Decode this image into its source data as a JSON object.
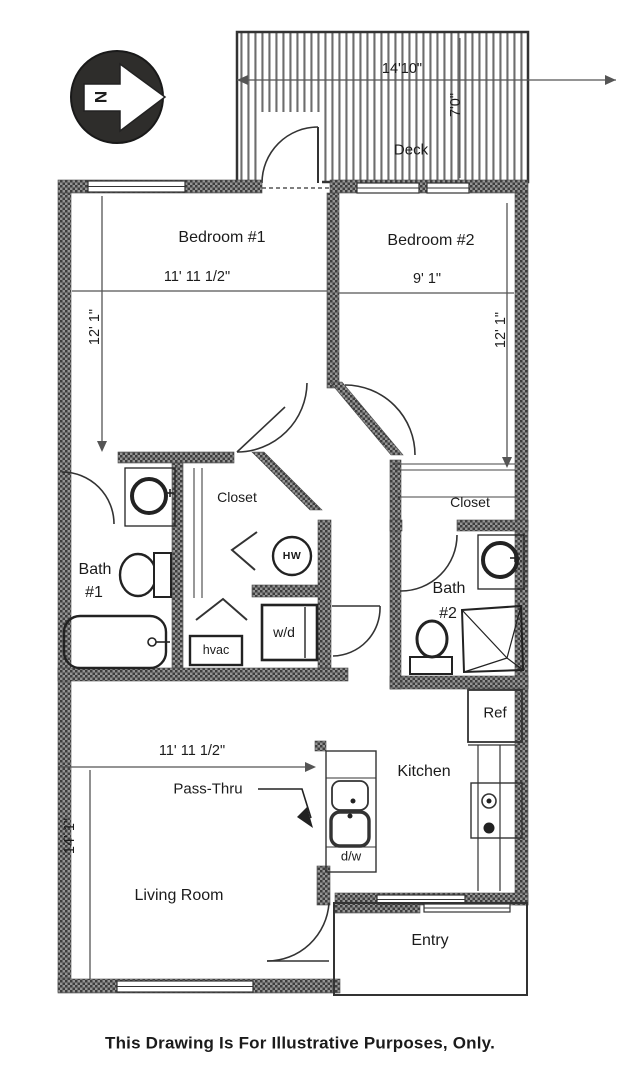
{
  "page": {
    "caption": "This Drawing  Is For Illustrative Purposes, Only."
  },
  "compass": {
    "label": "N"
  },
  "deck": {
    "label": "Deck",
    "width_dim": "14'10\"",
    "depth_dim": "7'0\""
  },
  "rooms": {
    "bedroom1": {
      "label": "Bedroom #1",
      "width_dim": "11' 11 1/2\"",
      "depth_dim": "12' 1\""
    },
    "bedroom2": {
      "label": "Bedroom #2",
      "width_dim": "9' 1\"",
      "depth_dim": "12' 1\""
    },
    "closet_left": {
      "label": "Closet"
    },
    "closet_right": {
      "label": "Closet"
    },
    "bath1": {
      "line1": "Bath",
      "line2": "#1"
    },
    "bath2": {
      "line1": "Bath",
      "line2": "#2"
    },
    "living": {
      "label": "Living Room",
      "width_dim": "11' 11 1/2\"",
      "depth_dim": "14' 1\""
    },
    "kitchen": {
      "label": "Kitchen"
    },
    "entry": {
      "label": "Entry"
    }
  },
  "fixtures": {
    "hw": "HW",
    "wd": "w/d",
    "hvac": "hvac",
    "ref": "Ref",
    "dw": "d/w",
    "passthru": "Pass-Thru"
  },
  "colors": {
    "ink": "#1b1b1b",
    "wall_dark": "#3d3d3d",
    "wall_light": "#949494"
  }
}
